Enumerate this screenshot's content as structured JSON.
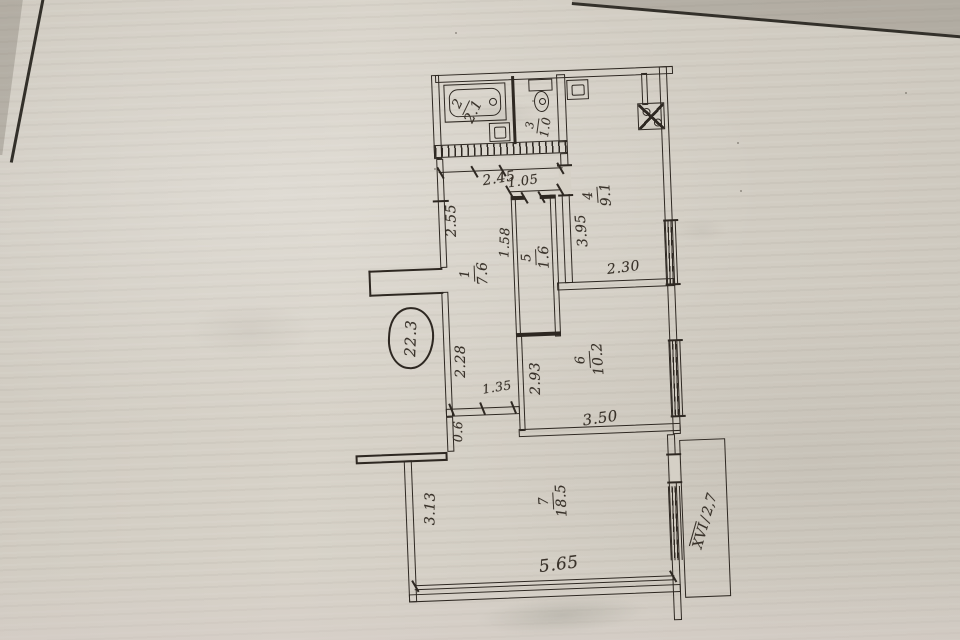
{
  "plan": {
    "total_area": "22.3",
    "balcony": {
      "numeral": "XVI",
      "sep": "/",
      "area": "2,7"
    },
    "rooms": [
      {
        "number": "1",
        "area": "7.6"
      },
      {
        "number": "2",
        "area": "2.1"
      },
      {
        "number": "3",
        "area": "1.0"
      },
      {
        "number": "4",
        "area": "9.1"
      },
      {
        "number": "5",
        "area": "1.6"
      },
      {
        "number": "6",
        "area": "10.2"
      },
      {
        "number": "7",
        "area": "18.5"
      }
    ],
    "dims": {
      "w245": "2.45",
      "w105": "1.05",
      "w255": "2.55",
      "w158": "1.58",
      "w395": "3.95",
      "w230": "2.30",
      "w228": "2.28",
      "w135": "1.35",
      "w293": "2.93",
      "w350": "3.50",
      "w06": "0.6",
      "w313": "3.13",
      "w565": "5.65"
    }
  }
}
